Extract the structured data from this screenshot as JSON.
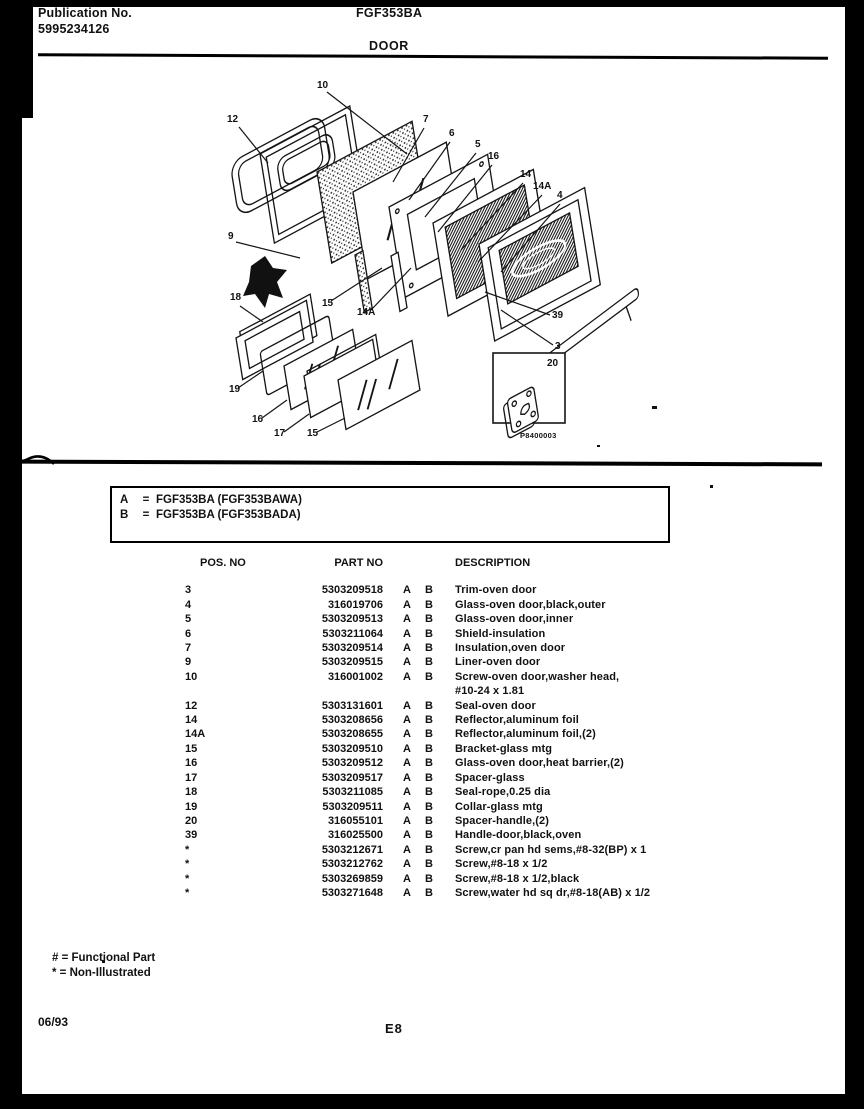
{
  "page": {
    "background": "#ffffff",
    "ink": "#111111"
  },
  "header": {
    "publication_label": "Publication No.",
    "publication_number": "5995234126",
    "model_number": "FGF353BA",
    "section_title": "DOOR"
  },
  "model_key": {
    "rows": [
      {
        "key": "A",
        "eq": "=",
        "value": "FGF353BA (FGF353BAWA)"
      },
      {
        "key": "B",
        "eq": "=",
        "value": "FGF353BA (FGF353BADA)"
      }
    ]
  },
  "diagram": {
    "figure_code": "P8400003",
    "callouts": [
      {
        "label": "10",
        "tx": 262,
        "ty": 18,
        "x1": 272,
        "y1": 22,
        "x2": 352,
        "y2": 84
      },
      {
        "label": "12",
        "tx": 172,
        "ty": 52,
        "x1": 184,
        "y1": 57,
        "x2": 213,
        "y2": 93
      },
      {
        "label": "7",
        "tx": 368,
        "ty": 52,
        "x1": 369,
        "y1": 58,
        "x2": 338,
        "y2": 112
      },
      {
        "label": "6",
        "tx": 394,
        "ty": 66,
        "x1": 395,
        "y1": 72,
        "x2": 354,
        "y2": 130
      },
      {
        "label": "5",
        "tx": 420,
        "ty": 77,
        "x1": 421,
        "y1": 83,
        "x2": 370,
        "y2": 147
      },
      {
        "label": "16",
        "tx": 433,
        "ty": 89,
        "x1": 437,
        "y1": 95,
        "x2": 383,
        "y2": 162
      },
      {
        "label": "14",
        "tx": 465,
        "ty": 107,
        "x1": 468,
        "y1": 113,
        "x2": 406,
        "y2": 180
      },
      {
        "label": "14A",
        "tx": 478,
        "ty": 119,
        "x1": 487,
        "y1": 125,
        "x2": 423,
        "y2": 192
      },
      {
        "label": "4",
        "tx": 502,
        "ty": 128,
        "x1": 505,
        "y1": 134,
        "x2": 446,
        "y2": 202
      },
      {
        "label": "9",
        "tx": 173,
        "ty": 169,
        "x1": 181,
        "y1": 172,
        "x2": 245,
        "y2": 188
      },
      {
        "label": "18",
        "tx": 175,
        "ty": 230,
        "x1": 185,
        "y1": 236,
        "x2": 208,
        "y2": 252
      },
      {
        "label": "15",
        "tx": 267,
        "ty": 236,
        "x1": 276,
        "y1": 231,
        "x2": 327,
        "y2": 198
      },
      {
        "label": "14A",
        "tx": 302,
        "ty": 245,
        "x1": 316,
        "y1": 240,
        "x2": 356,
        "y2": 198
      },
      {
        "label": "19",
        "tx": 174,
        "ty": 322,
        "x1": 183,
        "y1": 318,
        "x2": 208,
        "y2": 301
      },
      {
        "label": "16",
        "tx": 197,
        "ty": 352,
        "x1": 207,
        "y1": 348,
        "x2": 232,
        "y2": 330
      },
      {
        "label": "17",
        "tx": 219,
        "ty": 366,
        "x1": 229,
        "y1": 362,
        "x2": 254,
        "y2": 344
      },
      {
        "label": "15",
        "tx": 252,
        "ty": 366,
        "x1": 262,
        "y1": 362,
        "x2": 290,
        "y2": 348
      },
      {
        "label": "39",
        "tx": 497,
        "ty": 248,
        "x1": 495,
        "y1": 245,
        "x2": 430,
        "y2": 222
      },
      {
        "label": "3",
        "tx": 500,
        "ty": 279,
        "x1": 498,
        "y1": 275,
        "x2": 446,
        "y2": 240
      },
      {
        "label": "20",
        "tx": 492,
        "ty": 296
      }
    ]
  },
  "parts_table": {
    "headers": {
      "pos": "POS. NO",
      "part": "PART NO",
      "desc": "DESCRIPTION"
    },
    "rows": [
      {
        "pos": "3",
        "part": "5303209518",
        "a": "A",
        "b": "B",
        "desc": "Trim-oven door",
        "desc2": ""
      },
      {
        "pos": "4",
        "part": "316019706",
        "a": "A",
        "b": "B",
        "desc": "Glass-oven door,black,outer",
        "desc2": ""
      },
      {
        "pos": "5",
        "part": "5303209513",
        "a": "A",
        "b": "B",
        "desc": "Glass-oven door,inner",
        "desc2": ""
      },
      {
        "pos": "6",
        "part": "5303211064",
        "a": "A",
        "b": "B",
        "desc": "Shield-insulation",
        "desc2": ""
      },
      {
        "pos": "7",
        "part": "5303209514",
        "a": "A",
        "b": "B",
        "desc": "Insulation,oven door",
        "desc2": ""
      },
      {
        "pos": "9",
        "part": "5303209515",
        "a": "A",
        "b": "B",
        "desc": "Liner-oven door",
        "desc2": ""
      },
      {
        "pos": "10",
        "part": "316001002",
        "a": "A",
        "b": "B",
        "desc": "Screw-oven door,washer head,",
        "desc2": "#10-24 x 1.81"
      },
      {
        "pos": "12",
        "part": "5303131601",
        "a": "A",
        "b": "B",
        "desc": "Seal-oven door",
        "desc2": ""
      },
      {
        "pos": "14",
        "part": "5303208656",
        "a": "A",
        "b": "B",
        "desc": "Reflector,aluminum foil",
        "desc2": ""
      },
      {
        "pos": "14A",
        "part": "5303208655",
        "a": "A",
        "b": "B",
        "desc": "Reflector,aluminum foil,(2)",
        "desc2": ""
      },
      {
        "pos": "15",
        "part": "5303209510",
        "a": "A",
        "b": "B",
        "desc": "Bracket-glass mtg",
        "desc2": ""
      },
      {
        "pos": "16",
        "part": "5303209512",
        "a": "A",
        "b": "B",
        "desc": "Glass-oven door,heat barrier,(2)",
        "desc2": ""
      },
      {
        "pos": "17",
        "part": "5303209517",
        "a": "A",
        "b": "B",
        "desc": "Spacer-glass",
        "desc2": ""
      },
      {
        "pos": "18",
        "part": "5303211085",
        "a": "A",
        "b": "B",
        "desc": "Seal-rope,0.25 dia",
        "desc2": ""
      },
      {
        "pos": "19",
        "part": "5303209511",
        "a": "A",
        "b": "B",
        "desc": "Collar-glass mtg",
        "desc2": ""
      },
      {
        "pos": "20",
        "part": "316055101",
        "a": "A",
        "b": "B",
        "desc": "Spacer-handle,(2)",
        "desc2": ""
      },
      {
        "pos": "39",
        "part": "316025500",
        "a": "A",
        "b": "B",
        "desc": "Handle-door,black,oven",
        "desc2": ""
      },
      {
        "pos": "*",
        "part": "5303212671",
        "a": "A",
        "b": "B",
        "desc": "Screw,cr pan hd sems,#8-32(BP) x 1",
        "desc2": ""
      },
      {
        "pos": "*",
        "part": "5303212762",
        "a": "A",
        "b": "B",
        "desc": "Screw,#8-18 x 1/2",
        "desc2": ""
      },
      {
        "pos": "*",
        "part": "5303269859",
        "a": "A",
        "b": "B",
        "desc": "Screw,#8-18 x 1/2,black",
        "desc2": ""
      },
      {
        "pos": "*",
        "part": "5303271648",
        "a": "A",
        "b": "B",
        "desc": "Screw,water hd sq dr,#8-18(AB) x 1/2",
        "desc2": ""
      }
    ]
  },
  "footnotes": {
    "functional": "# = Functional Part",
    "non_illustrated": "* = Non-Illustrated"
  },
  "footer": {
    "date": "06/93",
    "page_code": "E8"
  }
}
